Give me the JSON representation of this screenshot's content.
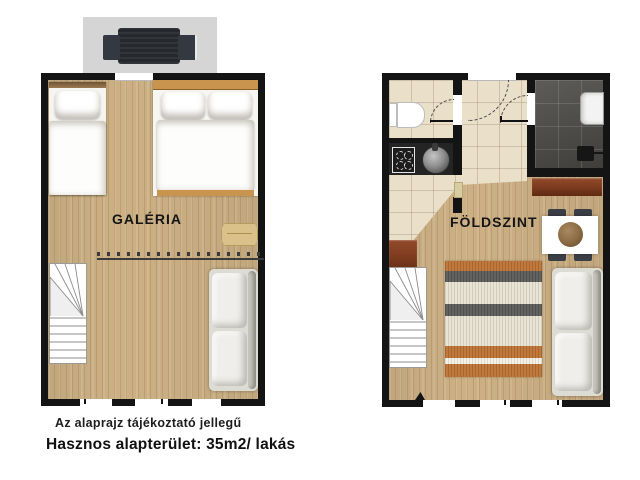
{
  "plans": {
    "galeria": {
      "label": "GALÉRIA"
    },
    "foldszint": {
      "label": "FÖLDSZINT"
    }
  },
  "footer": {
    "disclaimer": "Az alaprajz tájékoztató jellegű",
    "area_line": "Hasznos alapterület: 35m2/ lakás"
  },
  "legend": {
    "upper_floor_furniture": [
      "terrace-chair",
      "single-bed",
      "double-bed",
      "wall-shelf",
      "gallery-railing",
      "winder-stairs",
      "sofa"
    ],
    "ground_floor_furniture": [
      "toilet",
      "cooktop",
      "kitchen-sink",
      "shower-room",
      "washbasin",
      "shower-drain",
      "sideboard-cabinet",
      "dining-table",
      "dining-chairs",
      "winder-stairs",
      "striped-rug",
      "sofa"
    ]
  },
  "colors": {
    "wall": "#141414",
    "wood_floor": "#cdb185",
    "tile_floor": "#eadfc9",
    "shower_tile": "#4f4e4b",
    "terrace": "#d5d5d5",
    "accent_brown": "#7b3a1e",
    "rug_orange": "#bd7233",
    "headboard_wood": "#c9954e"
  }
}
